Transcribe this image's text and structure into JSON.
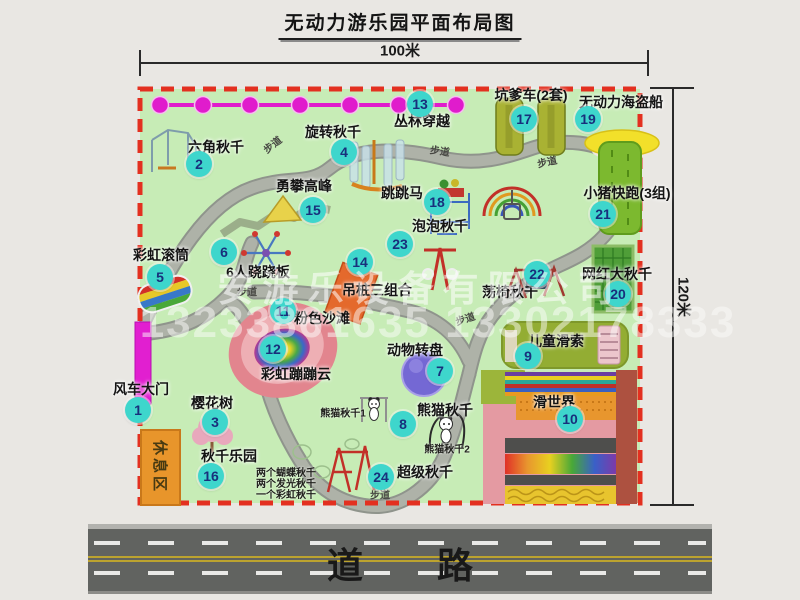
{
  "title": "无动力游乐园平面布局图",
  "dimensions": {
    "top": "100米",
    "right": "120米"
  },
  "road": {
    "label": "道路"
  },
  "watermark": {
    "company": "安游乐设备有限公司",
    "phone": "13233861635 13302178333"
  },
  "rest_area": {
    "label": "休息区"
  },
  "walkway_label": "步道",
  "walkways": [
    {
      "x": 272,
      "y": 144,
      "r": -38
    },
    {
      "x": 440,
      "y": 150,
      "r": 8
    },
    {
      "x": 547,
      "y": 161,
      "r": -12
    },
    {
      "x": 247,
      "y": 291,
      "r": 0
    },
    {
      "x": 465,
      "y": 318,
      "r": -18
    },
    {
      "x": 380,
      "y": 494,
      "r": 0
    }
  ],
  "attractions": [
    {
      "num": "1",
      "name": "风车大门",
      "bubble": [
        138,
        410
      ],
      "label": [
        141,
        389
      ]
    },
    {
      "num": "2",
      "name": "六角秋千",
      "bubble": [
        199,
        164
      ],
      "label": [
        216,
        147
      ]
    },
    {
      "num": "3",
      "name": "樱花树",
      "bubble": [
        215,
        422
      ],
      "label": [
        212,
        403
      ]
    },
    {
      "num": "4",
      "name": "旋转秋千",
      "bubble": [
        344,
        152
      ],
      "label": [
        333,
        132
      ]
    },
    {
      "num": "5",
      "name": "彩虹滚筒",
      "bubble": [
        160,
        277
      ],
      "label": [
        161,
        255
      ]
    },
    {
      "num": "6",
      "name": "6人跷跷板",
      "bubble": [
        224,
        252
      ],
      "label": [
        258,
        272
      ]
    },
    {
      "num": "7",
      "name": "动物转盘",
      "bubble": [
        440,
        371
      ],
      "label": [
        415,
        350
      ]
    },
    {
      "num": "8",
      "name": "熊猫秋千",
      "bubble": [
        403,
        424
      ],
      "label": [
        445,
        410
      ]
    },
    {
      "num": "9",
      "name": "儿童滑索",
      "bubble": [
        528,
        356
      ],
      "label": [
        556,
        341
      ]
    },
    {
      "num": "10",
      "name": "滑世界",
      "bubble": [
        570,
        419
      ],
      "label": [
        554,
        402
      ]
    },
    {
      "num": "11",
      "name": "粉色沙滩",
      "bubble": [
        283,
        311
      ],
      "label": [
        322,
        318
      ]
    },
    {
      "num": "12",
      "name": "彩虹蹦蹦云",
      "bubble": [
        273,
        349
      ],
      "label": [
        296,
        374
      ]
    },
    {
      "num": "13",
      "name": "丛林穿越",
      "bubble": [
        420,
        104
      ],
      "label": [
        422,
        121
      ]
    },
    {
      "num": "14",
      "name": "吊桩三组合",
      "bubble": [
        360,
        262
      ],
      "label": [
        377,
        290
      ]
    },
    {
      "num": "15",
      "name": "勇攀高峰",
      "bubble": [
        313,
        210
      ],
      "label": [
        304,
        186
      ]
    },
    {
      "num": "16",
      "name": "秋千乐园",
      "bubble": [
        211,
        476
      ],
      "label": [
        229,
        456
      ],
      "notes": [
        "两个蝴蝶秋千",
        "两个发光秋千",
        "一个彩虹秋千"
      ],
      "notes_pos": [
        256,
        464
      ]
    },
    {
      "num": "17",
      "name": "坑爹车(2套)",
      "bubble": [
        524,
        119
      ],
      "label": [
        531,
        95
      ]
    },
    {
      "num": "18",
      "name": "跳跳马",
      "bubble": [
        437,
        202
      ],
      "label": [
        402,
        193
      ]
    },
    {
      "num": "19",
      "name": "无动力海盗船",
      "bubble": [
        588,
        119
      ],
      "label": [
        621,
        102
      ]
    },
    {
      "num": "20",
      "name": "网红大秋千",
      "bubble": [
        618,
        294
      ],
      "label": [
        617,
        274
      ]
    },
    {
      "num": "21",
      "name": "小猪快跑(3组)",
      "bubble": [
        603,
        214
      ],
      "label": [
        627,
        193
      ]
    },
    {
      "num": "22",
      "name": "荡椅秋千",
      "bubble": [
        537,
        274
      ],
      "label": [
        510,
        292
      ]
    },
    {
      "num": "23",
      "name": "泡泡秋千",
      "bubble": [
        400,
        244
      ],
      "label": [
        440,
        226
      ]
    },
    {
      "num": "24",
      "name": "超级秋千",
      "bubble": [
        381,
        477
      ],
      "label": [
        425,
        472
      ]
    }
  ],
  "sub_labels": [
    {
      "text": "熊猫秋千1",
      "x": 343,
      "y": 412
    },
    {
      "text": "熊猫秋千2",
      "x": 447,
      "y": 448
    }
  ],
  "colors": {
    "park_green": "#c7ecb6",
    "border_red": "#e33020",
    "bubble_teal": "#3ed6cc",
    "magenta": "#e11fd0",
    "path_gray": "#aeb2a8",
    "road_gray": "#616360",
    "rest_orange": "#e8952b"
  }
}
